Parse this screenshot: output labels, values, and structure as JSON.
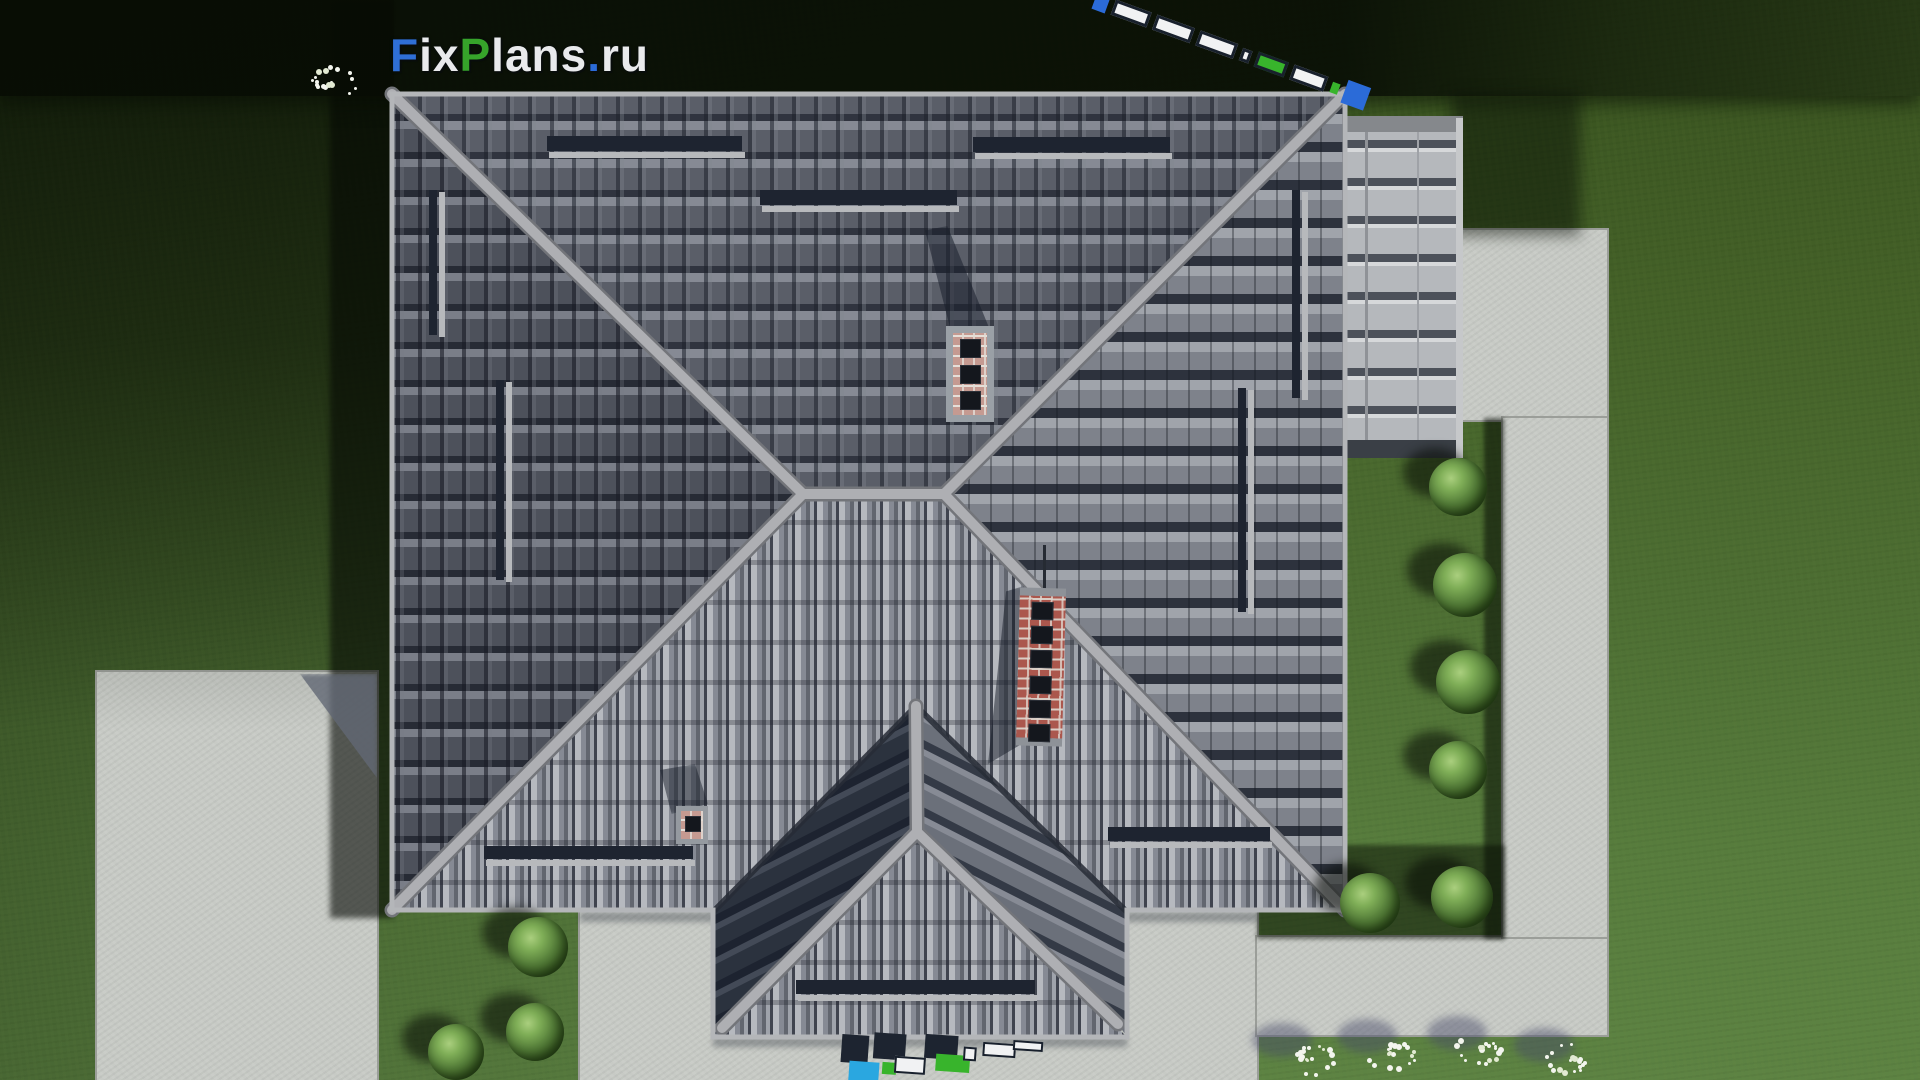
{
  "watermark": {
    "brand": {
      "p1": "F",
      "p2": "ix",
      "p3": "P",
      "p4": "lans",
      "p5": ".",
      "p6": "ru"
    },
    "brand_colors": {
      "p1": "#2f6fd6",
      "p2": "#e9eaec",
      "p3": "#36a32a",
      "p4": "#e9eaec",
      "p5": "#2b6bd8",
      "p6": "#e9eaec"
    }
  },
  "colors": {
    "guard_bar": "#1e2430",
    "guard_rail": "#b7b9bc",
    "strip_navy": "#1d2430",
    "strip_white": "#f1f2f3",
    "strip_green": "#38b42c",
    "strip_cyan": "#2aa7e0",
    "strip_blue": "#2b6bd8",
    "strip_outline": "#18202c",
    "flower_white": "#f3f5ee",
    "flower_cream": "#e2ead2"
  },
  "scene": {
    "description": "aerial top-down render of hip-roof house with chimneys, snow guards, concrete paths, lawn, bushes and flower beds",
    "concrete_slabs": [
      {
        "name": "left-pad",
        "x": 97,
        "y": 672,
        "w": 280,
        "h": 408
      },
      {
        "name": "patio",
        "x": 580,
        "y": 912,
        "w": 677,
        "h": 168
      },
      {
        "name": "path-horizontal",
        "x": 1257,
        "y": 937,
        "w": 350,
        "h": 98
      },
      {
        "name": "path-vertical-top",
        "x": 1463,
        "y": 230,
        "w": 144,
        "h": 190
      },
      {
        "name": "path-vertical",
        "x": 1503,
        "y": 418,
        "w": 104,
        "h": 519
      }
    ],
    "snow_guards": [
      {
        "x": 547,
        "y": 136,
        "w": 195,
        "h": 15,
        "t": "bar"
      },
      {
        "x": 549,
        "y": 152,
        "w": 196,
        "h": 6,
        "t": "rail"
      },
      {
        "x": 760,
        "y": 190,
        "w": 197,
        "h": 15,
        "t": "bar"
      },
      {
        "x": 762,
        "y": 206,
        "w": 197,
        "h": 6,
        "t": "rail"
      },
      {
        "x": 973,
        "y": 137,
        "w": 197,
        "h": 15,
        "t": "bar"
      },
      {
        "x": 975,
        "y": 153,
        "w": 197,
        "h": 6,
        "t": "rail"
      },
      {
        "x": 429,
        "y": 190,
        "w": 8,
        "h": 145,
        "t": "bar"
      },
      {
        "x": 439,
        "y": 192,
        "w": 6,
        "h": 145,
        "t": "rail"
      },
      {
        "x": 496,
        "y": 380,
        "w": 8,
        "h": 200,
        "t": "bar"
      },
      {
        "x": 506,
        "y": 382,
        "w": 6,
        "h": 200,
        "t": "rail"
      },
      {
        "x": 1238,
        "y": 388,
        "w": 8,
        "h": 224,
        "t": "bar"
      },
      {
        "x": 1248,
        "y": 390,
        "w": 6,
        "h": 224,
        "t": "rail"
      },
      {
        "x": 1292,
        "y": 190,
        "w": 8,
        "h": 208,
        "t": "bar"
      },
      {
        "x": 1302,
        "y": 192,
        "w": 6,
        "h": 208,
        "t": "rail"
      },
      {
        "x": 484,
        "y": 846,
        "w": 209,
        "h": 13,
        "t": "bar"
      },
      {
        "x": 486,
        "y": 860,
        "w": 209,
        "h": 6,
        "t": "rail"
      },
      {
        "x": 1108,
        "y": 827,
        "w": 162,
        "h": 14,
        "t": "bar"
      },
      {
        "x": 1110,
        "y": 842,
        "w": 162,
        "h": 6,
        "t": "rail"
      },
      {
        "x": 796,
        "y": 980,
        "w": 239,
        "h": 14,
        "t": "bar"
      },
      {
        "x": 798,
        "y": 995,
        "w": 239,
        "h": 6,
        "t": "rail"
      }
    ],
    "bushes": [
      {
        "x": 1458,
        "y": 487,
        "r": 29
      },
      {
        "x": 1465,
        "y": 585,
        "r": 32
      },
      {
        "x": 1468,
        "y": 682,
        "r": 32
      },
      {
        "x": 1458,
        "y": 770,
        "r": 29
      },
      {
        "x": 1370,
        "y": 903,
        "r": 30
      },
      {
        "x": 1462,
        "y": 897,
        "r": 31
      },
      {
        "x": 538,
        "y": 947,
        "r": 30
      },
      {
        "x": 535,
        "y": 1032,
        "r": 29
      },
      {
        "x": 456,
        "y": 1052,
        "r": 28
      }
    ],
    "flower_clusters": [
      {
        "x": 328,
        "y": 82,
        "shadow": false
      },
      {
        "x": 1310,
        "y": 1057,
        "shadow": true
      },
      {
        "x": 1395,
        "y": 1053,
        "shadow": true
      },
      {
        "x": 1485,
        "y": 1050,
        "shadow": true
      },
      {
        "x": 1572,
        "y": 1062,
        "shadow": true
      }
    ],
    "strip_top_right": [
      {
        "w": 14,
        "h": 18,
        "c": "strip_blue",
        "o": false
      },
      {
        "w": 38,
        "h": 16,
        "c": "strip_white",
        "o": true
      },
      {
        "w": 40,
        "h": 16,
        "c": "strip_white",
        "o": true
      },
      {
        "w": 40,
        "h": 16,
        "c": "strip_white",
        "o": true
      },
      {
        "w": 10,
        "h": 13,
        "c": "strip_white",
        "o": true
      },
      {
        "w": 32,
        "h": 16,
        "c": "strip_green",
        "o": true
      },
      {
        "w": 36,
        "h": 16,
        "c": "strip_white",
        "o": true
      },
      {
        "w": 8,
        "h": 11,
        "c": "strip_green",
        "o": false
      },
      {
        "w": 24,
        "h": 24,
        "c": "strip_blue",
        "o": false
      }
    ],
    "strip_bottom": [
      {
        "x": 1,
        "y": 8,
        "w": 27,
        "h": 28,
        "c": "strip_navy",
        "o": false
      },
      {
        "x": 10,
        "y": 34,
        "w": 30,
        "h": 20,
        "c": "strip_cyan",
        "o": false
      },
      {
        "x": 33,
        "y": 4,
        "w": 32,
        "h": 26,
        "c": "strip_navy",
        "o": false
      },
      {
        "x": 43,
        "y": 33,
        "w": 14,
        "h": 12,
        "c": "strip_green",
        "o": false
      },
      {
        "x": 55,
        "y": 26,
        "w": 31,
        "h": 17,
        "c": "strip_white",
        "o": true
      },
      {
        "x": 84,
        "y": 2,
        "w": 33,
        "h": 24,
        "c": "strip_navy",
        "o": false
      },
      {
        "x": 96,
        "y": 21,
        "w": 34,
        "h": 17,
        "c": "strip_green",
        "o": false
      },
      {
        "x": 123,
        "y": 12,
        "w": 13,
        "h": 14,
        "c": "strip_white",
        "o": true
      },
      {
        "x": 142,
        "y": 6,
        "w": 33,
        "h": 14,
        "c": "strip_white",
        "o": true
      },
      {
        "x": 172,
        "y": 2,
        "w": 30,
        "h": 10,
        "c": "strip_white",
        "o": true
      }
    ]
  }
}
